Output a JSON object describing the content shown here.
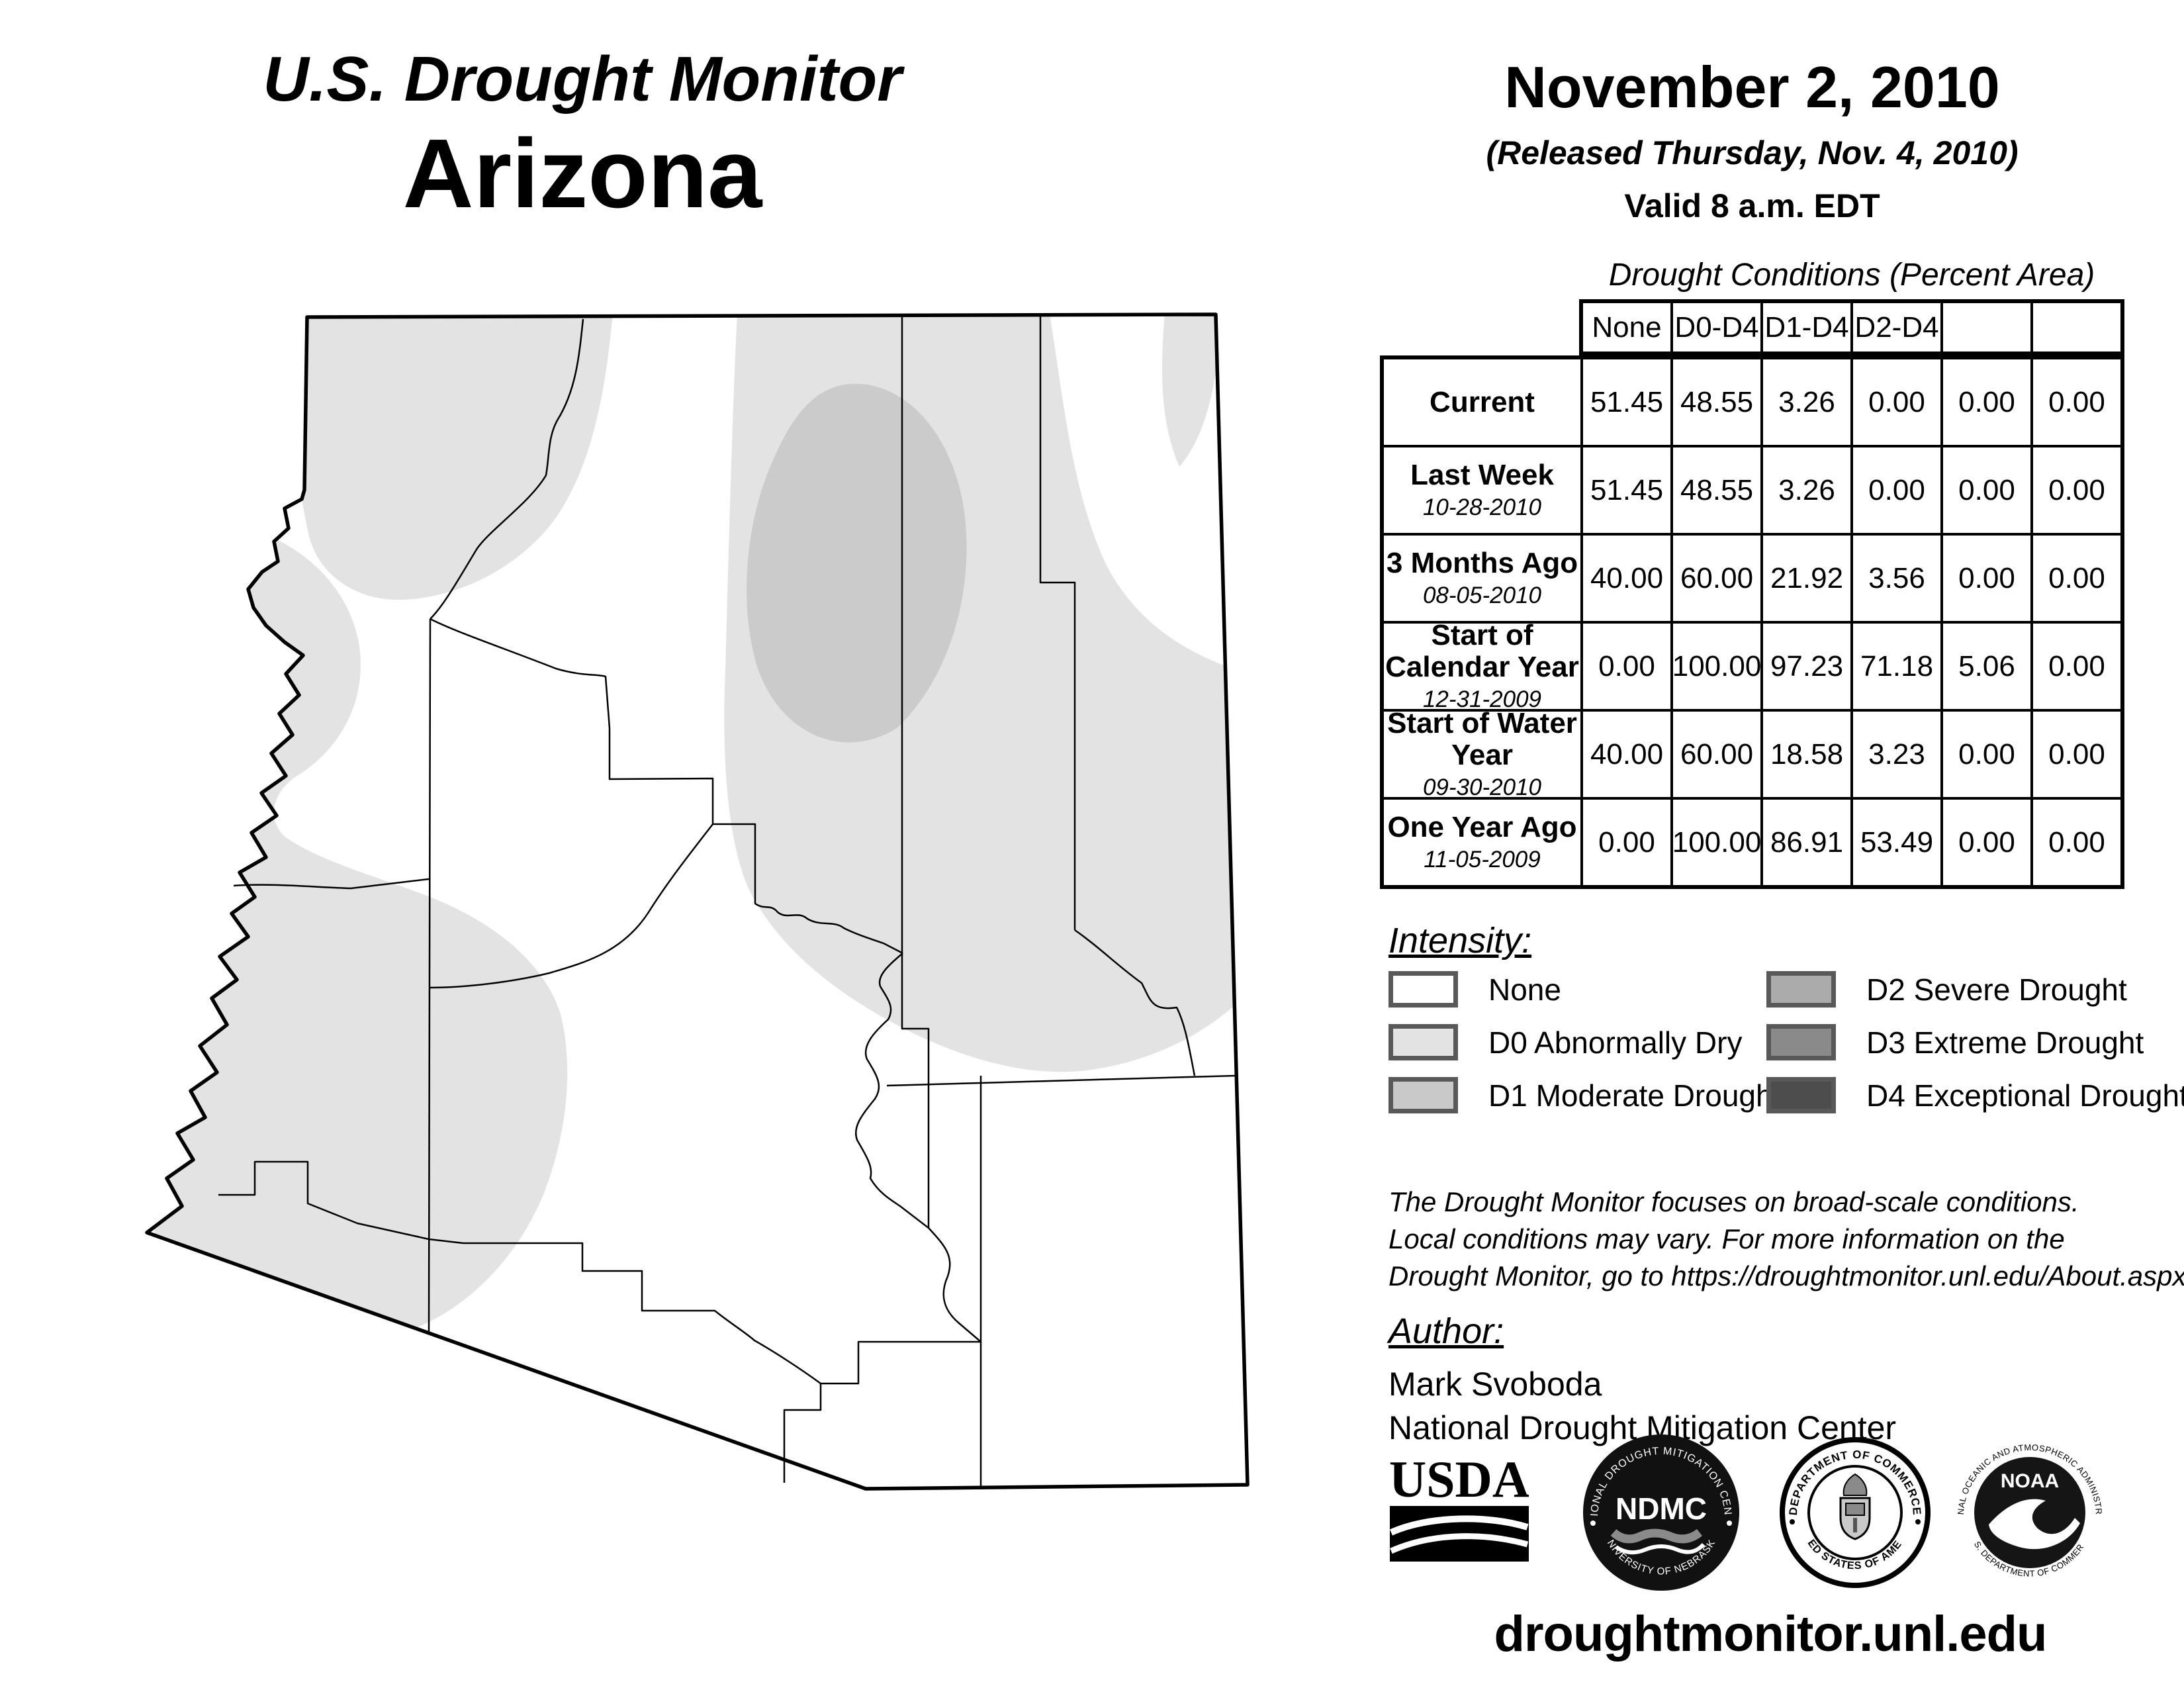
{
  "page": {
    "title_line1": "U.S. Drought Monitor",
    "title_line2": "Arizona"
  },
  "date_block": {
    "map_date": "November 2, 2010",
    "released": "(Released Thursday, Nov. 4, 2010)",
    "valid": "Valid 8 a.m. EDT"
  },
  "drought_table": {
    "caption": "Drought Conditions (Percent Area)",
    "columns": [
      "None",
      "D0-D4",
      "D1-D4",
      "D2-D4",
      "D3-D4",
      "D4"
    ],
    "column_colors": [
      "#ffffff",
      "#e3e3e3",
      "#c9c9c9",
      "#ababab",
      "#8a8a8a",
      "#4d4d4d"
    ],
    "rows": [
      {
        "label": "Current",
        "date": "",
        "values": [
          "51.45",
          "48.55",
          "3.26",
          "0.00",
          "0.00",
          "0.00"
        ]
      },
      {
        "label": "Last Week",
        "date": "10-28-2010",
        "values": [
          "51.45",
          "48.55",
          "3.26",
          "0.00",
          "0.00",
          "0.00"
        ]
      },
      {
        "label": "3 Months Ago",
        "date": "08-05-2010",
        "values": [
          "40.00",
          "60.00",
          "21.92",
          "3.56",
          "0.00",
          "0.00"
        ]
      },
      {
        "label": "Start of Calendar Year",
        "date": "12-31-2009",
        "values": [
          "0.00",
          "100.00",
          "97.23",
          "71.18",
          "5.06",
          "0.00"
        ]
      },
      {
        "label": "Start of Water Year",
        "date": "09-30-2010",
        "values": [
          "40.00",
          "60.00",
          "18.58",
          "3.23",
          "0.00",
          "0.00"
        ]
      },
      {
        "label": "One Year Ago",
        "date": "11-05-2009",
        "values": [
          "0.00",
          "100.00",
          "86.91",
          "53.49",
          "0.00",
          "0.00"
        ]
      }
    ]
  },
  "legend": {
    "heading": "Intensity:",
    "items": [
      {
        "label": "None",
        "color": "#ffffff"
      },
      {
        "label": "D0 Abnormally Dry",
        "color": "#e3e3e3"
      },
      {
        "label": "D1 Moderate Drought",
        "color": "#c9c9c9"
      },
      {
        "label": "D2 Severe Drought",
        "color": "#ababab"
      },
      {
        "label": "D3 Extreme Drought",
        "color": "#8a8a8a"
      },
      {
        "label": "D4 Exceptional Drought",
        "color": "#4d4d4d"
      }
    ]
  },
  "disclaimer": {
    "line1": "The Drought Monitor focuses on broad-scale conditions.",
    "line2": "Local conditions may vary. For more information on the",
    "line3": "Drought Monitor, go to https://droughtmonitor.unl.edu/About.aspx"
  },
  "author_block": {
    "heading": "Author:",
    "name": "Mark Svoboda",
    "org": "National Drought Mitigation Center"
  },
  "logos": {
    "usda": {
      "text": "USDA"
    },
    "ndmc": {
      "ring_top": "NATIONAL DROUGHT MITIGATION CENTER",
      "ring_bottom": "UNIVERSITY OF NEBRASKA",
      "center": "NDMC"
    },
    "doc": {
      "ring_top": "DEPARTMENT OF COMMERCE",
      "ring_bottom": "UNITED STATES OF AMERICA"
    },
    "noaa": {
      "ring_top": "NATIONAL OCEANIC AND ATMOSPHERIC ADMINISTRATION",
      "ring_bottom": "U.S. DEPARTMENT OF COMMERCE",
      "center": "NOAA"
    }
  },
  "footer": {
    "url": "droughtmonitor.unl.edu"
  },
  "map": {
    "region": "Arizona",
    "fill_none": "#ffffff",
    "fill_d0": "#e3e3e3",
    "fill_d1": "#cbcbcb",
    "border_color": "#000000"
  }
}
